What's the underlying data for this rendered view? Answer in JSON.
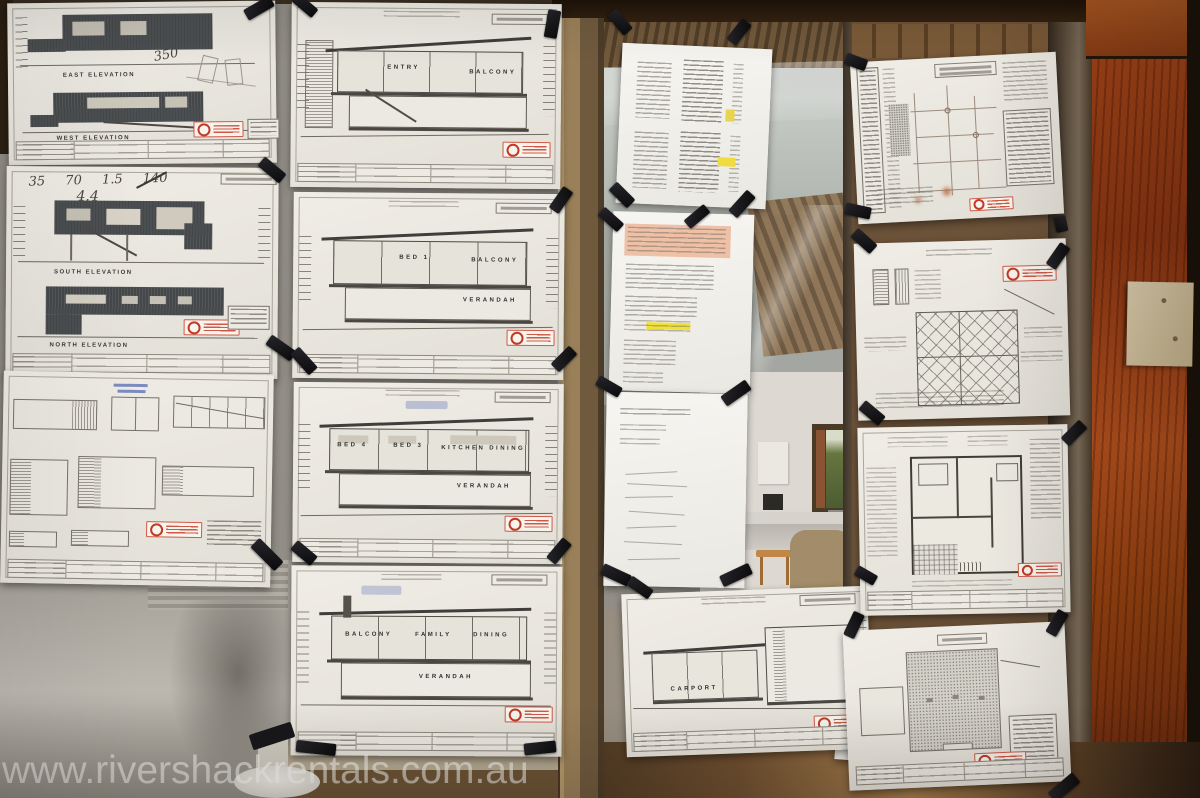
{
  "watermark": "www.rivershackrentals.com.au",
  "sheets": {
    "elevations1": {
      "label_top": "EAST ELEVATION",
      "label_bottom": "WEST ELEVATION",
      "note": "350"
    },
    "elevations2": {
      "label_top": "SOUTH ELEVATION",
      "label_bottom": "NORTH ELEVATION",
      "note_row": "35  70  1.5  140",
      "note_2": "4.4"
    },
    "section_entry": {
      "r1": "ENTRY",
      "r2": "BALCONY"
    },
    "section_bed1": {
      "r1": "BED 1",
      "r2": "BALCONY",
      "r3": "VERANDAH"
    },
    "section_beds": {
      "r1": "BED 4",
      "r2": "BED 3",
      "r3": "KITCHEN",
      "r4": "DINING",
      "r5": "VERANDAH"
    },
    "section_family": {
      "r1": "BALCONY",
      "r2": "FAMILY",
      "r3": "DINING",
      "r4": "VERANDAH"
    },
    "section_carport": {
      "r1": "CARPORT"
    }
  }
}
